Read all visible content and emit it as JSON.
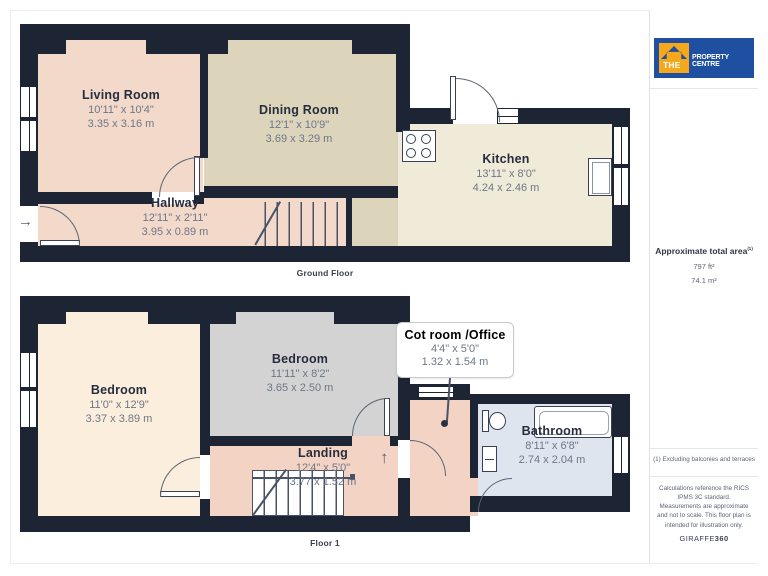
{
  "branding": {
    "logo_the": "THE",
    "logo_rest": "PROPERTY CENTRE",
    "giraffe_normal": "GIRAFFE",
    "giraffe_bold": "360"
  },
  "sidebar": {
    "total_area_label": "Approximate total area",
    "total_area_sup": "(1)",
    "total_area_ft": "797 ft²",
    "total_area_m": "74.1 m²",
    "footnote": "(1) Excluding balconies and terraces",
    "disclaimer": "Calculations reference the RICS IPMS 3C standard. Measurements are approximate and not to scale. This floor plan is intended for illustration only."
  },
  "floors": {
    "ground": {
      "caption": "Ground Floor",
      "rooms": {
        "living": {
          "name": "Living Room",
          "imperial": "10'11\" x 10'4\"",
          "metric": "3.35 x 3.16 m"
        },
        "dining": {
          "name": "Dining Room",
          "imperial": "12'1\" x 10'9\"",
          "metric": "3.69 x 3.29 m"
        },
        "kitchen": {
          "name": "Kitchen",
          "imperial": "13'11\" x 8'0\"",
          "metric": "4.24 x 2.46 m"
        },
        "hallway": {
          "name": "Hallway",
          "imperial": "12'11\" x 2'11\"",
          "metric": "3.95 x 0.89 m"
        }
      }
    },
    "floor1": {
      "caption": "Floor 1",
      "rooms": {
        "bedroom_left": {
          "name": "Bedroom",
          "imperial": "11'0\" x 12'9\"",
          "metric": "3.37 x 3.89 m"
        },
        "bedroom_mid": {
          "name": "Bedroom",
          "imperial": "11'11\" x 8'2\"",
          "metric": "3.65 x 2.50 m"
        },
        "cot": {
          "name": "Cot room /Office",
          "imperial": "4'4\" x 5'0\"",
          "metric": "1.32 x 1.54 m"
        },
        "landing": {
          "name": "Landing",
          "imperial": "12'4\" x 5'0\"",
          "metric": "3.77 x 1.52 m"
        },
        "bathroom": {
          "name": "Bathroom",
          "imperial": "8'11\" x 6'8\"",
          "metric": "2.74 x 2.04 m"
        }
      }
    }
  },
  "icons": {
    "entry_arrow": "→",
    "stairs_up_arrow": "↑"
  },
  "colors": {
    "wall": "#1d2433",
    "living_room": "#f2d9ca",
    "dining_room": "#dcd5bb",
    "kitchen": "#f0ebd9",
    "hallway": "#f2d9ca",
    "bedroom_left": "#fbeedd",
    "bedroom_mid": "#d3d3d3",
    "landing": "#f3d4c4",
    "bathroom": "#dfe5ef",
    "logo_blue": "#1f4fa0",
    "logo_yellow": "#f5a81c"
  }
}
